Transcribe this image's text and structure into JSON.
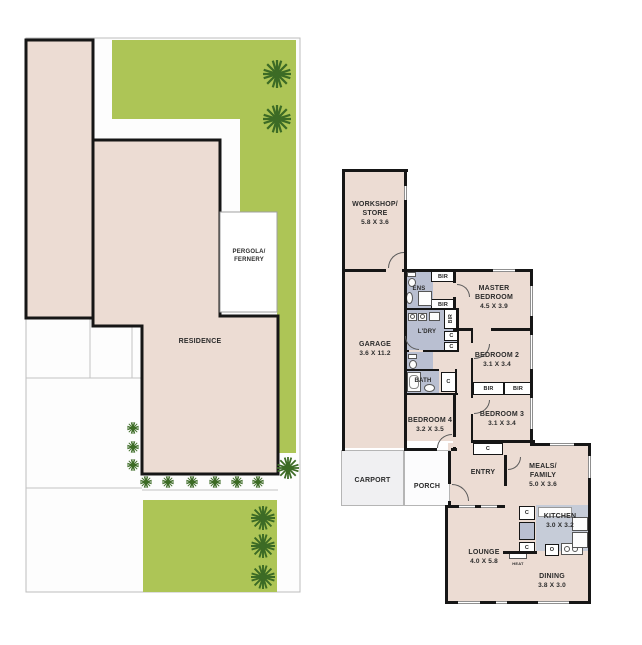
{
  "site_plan": {
    "residence_label": "RESIDENCE",
    "pergola_line1": "PERGOLA/",
    "pergola_line2": "FERNERY"
  },
  "floor_plan": {
    "workshop_line1": "WORKSHOP/",
    "workshop_line2": "STORE",
    "workshop_dims": "5.8 X 3.6",
    "garage_name": "GARAGE",
    "garage_dims": "3.6 X 11.2",
    "ens_label": "ENS",
    "bir_label": "BIR",
    "master_line1": "MASTER",
    "master_line2": "BEDROOM",
    "master_dims": "4.5 X 3.9",
    "laundry_label": "L'DRY",
    "cupboard_label": "C",
    "bedroom2_name": "BEDROOM 2",
    "bedroom2_dims": "3.1 X 3.4",
    "bath_label": "BATH",
    "bedroom3_name": "BEDROOM 3",
    "bedroom3_dims": "3.1 X 3.4",
    "bedroom4_name": "BEDROOM 4",
    "bedroom4_dims": "3.2 X 3.5",
    "entry_label": "ENTRY",
    "carport_label": "CARPORT",
    "porch_label": "PORCH",
    "meals_line1": "MEALS/",
    "meals_line2": "FAMILY",
    "meals_dims": "5.0 X 3.6",
    "kitchen_name": "KITCHEN",
    "kitchen_dims": "3.0 X 3.2",
    "oven_label": "O",
    "heat_label": "HEAT",
    "lounge_name": "LOUNGE",
    "lounge_dims": "4.0 X 5.8",
    "dining_name": "DINING",
    "dining_dims": "3.8 X 3.0"
  },
  "colors": {
    "floor_beige": "#ecdcd3",
    "lawn_green": "#adc556",
    "wet_area_gray": "#b9bfd1",
    "kitchen_gray": "#c6ccd8",
    "wall_black": "#161616",
    "carport_gray": "#f0f0f2",
    "tree_green": "#3c6b25"
  }
}
